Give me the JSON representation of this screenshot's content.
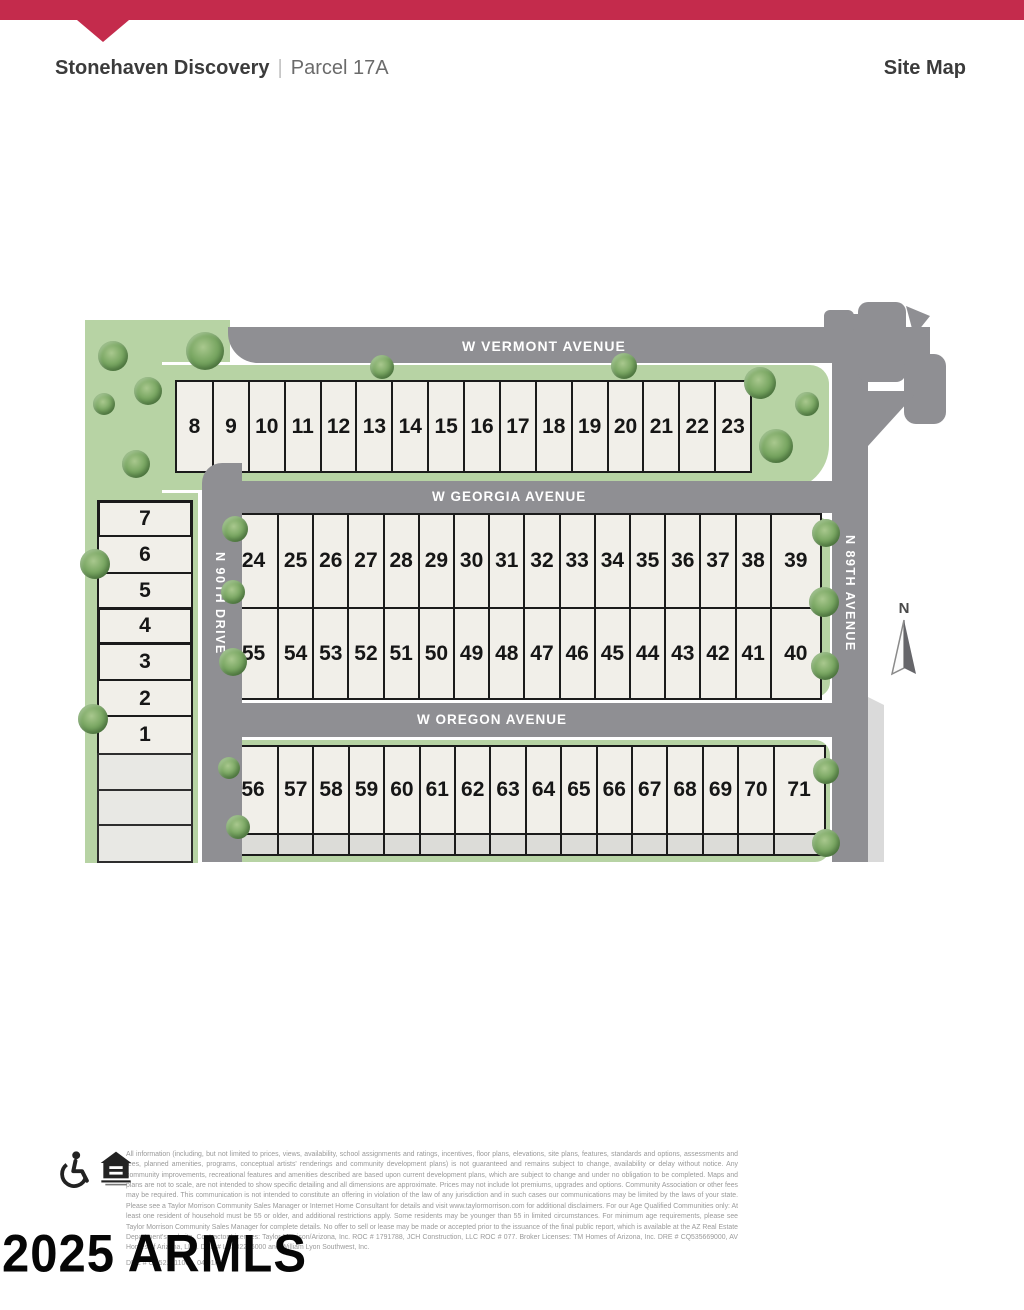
{
  "header": {
    "title": "Stonehaven Discovery",
    "separator": "|",
    "parcel": "Parcel 17A",
    "page_label": "Site Map"
  },
  "map": {
    "streets": {
      "vermont": "W VERMONT AVENUE",
      "georgia": "W GEORGIA AVENUE",
      "oregon": "W OREGON AVENUE",
      "drive90": "N 90TH DRIVE",
      "ave89": "N 89TH AVENUE"
    },
    "north_label": "N",
    "lots": {
      "top": [
        "8",
        "9",
        "10",
        "11",
        "12",
        "13",
        "14",
        "15",
        "16",
        "17",
        "18",
        "19",
        "20",
        "21",
        "22",
        "23"
      ],
      "middle_upper": [
        "24",
        "25",
        "26",
        "27",
        "28",
        "29",
        "30",
        "31",
        "32",
        "33",
        "34",
        "35",
        "36",
        "37",
        "38",
        "39"
      ],
      "middle_lower": [
        "55",
        "54",
        "53",
        "52",
        "51",
        "50",
        "49",
        "48",
        "47",
        "46",
        "45",
        "44",
        "43",
        "42",
        "41",
        "40"
      ],
      "bottom": [
        "56",
        "57",
        "58",
        "59",
        "60",
        "61",
        "62",
        "63",
        "64",
        "65",
        "66",
        "67",
        "68",
        "69",
        "70",
        "71"
      ],
      "left": [
        "7",
        "6",
        "5",
        "4",
        "3",
        "2",
        "1"
      ]
    }
  },
  "colors": {
    "accent": "#c42b4c",
    "road": "#8f8f93",
    "green": "#b7d3a4",
    "lot_fill": "#f1efe9",
    "alley_fill": "#dcdcd8"
  },
  "footer": {
    "disclaimer": "All information (including, but not limited to prices, views, availability, school assignments and ratings, incentives, floor plans, elevations, site plans, features, standards and options, assessments and fees, planned amenities, programs, conceptual artists' renderings and community development plans) is not guaranteed and remains subject to change, availability or delay without notice. Any community improvements, recreational features and amenities described are based upon current development plans, which are subject to change and under no obligation to be completed. Maps and plans are not to scale, are not intended to show specific detailing and all dimensions are approximate. Prices may not include lot premiums, upgrades and options. Community Association or other fees may be required. This communication is not intended to constitute an offering in violation of the law of any jurisdiction and in such cases our communications may be limited by the laws of your state. Please see a Taylor Morrison Community Sales Manager or Internet Home Consultant for details and visit www.taylormorrison.com for additional disclaimers. For our Age Qualified Communities only: At least one resident of household must be 55 or older, and additional restrictions apply. Some residents may be younger than 55 in limited circumstances. For minimum age requirements, please see Taylor Morrison Community Sales Manager for complete details. No offer to sell or lease may be made or accepted prior to the issuance of the final public report, which is available at the AZ Real Estate Department's website. Contractor Licenses: Taylor Morrison/Arizona, Inc. ROC # 1791788, JCH Construction, LLC ROC # 077. Broker Licenses: TM Homes of Arizona, Inc. DRE # CQ535669000, AV Homes of Arizona, LLC. DRE # LC632206000 and William Lyon Southwest, Inc.",
    "dre_line": "DRE # CD521011000.  04/01/22",
    "watermark": "2025 ARMLS"
  }
}
